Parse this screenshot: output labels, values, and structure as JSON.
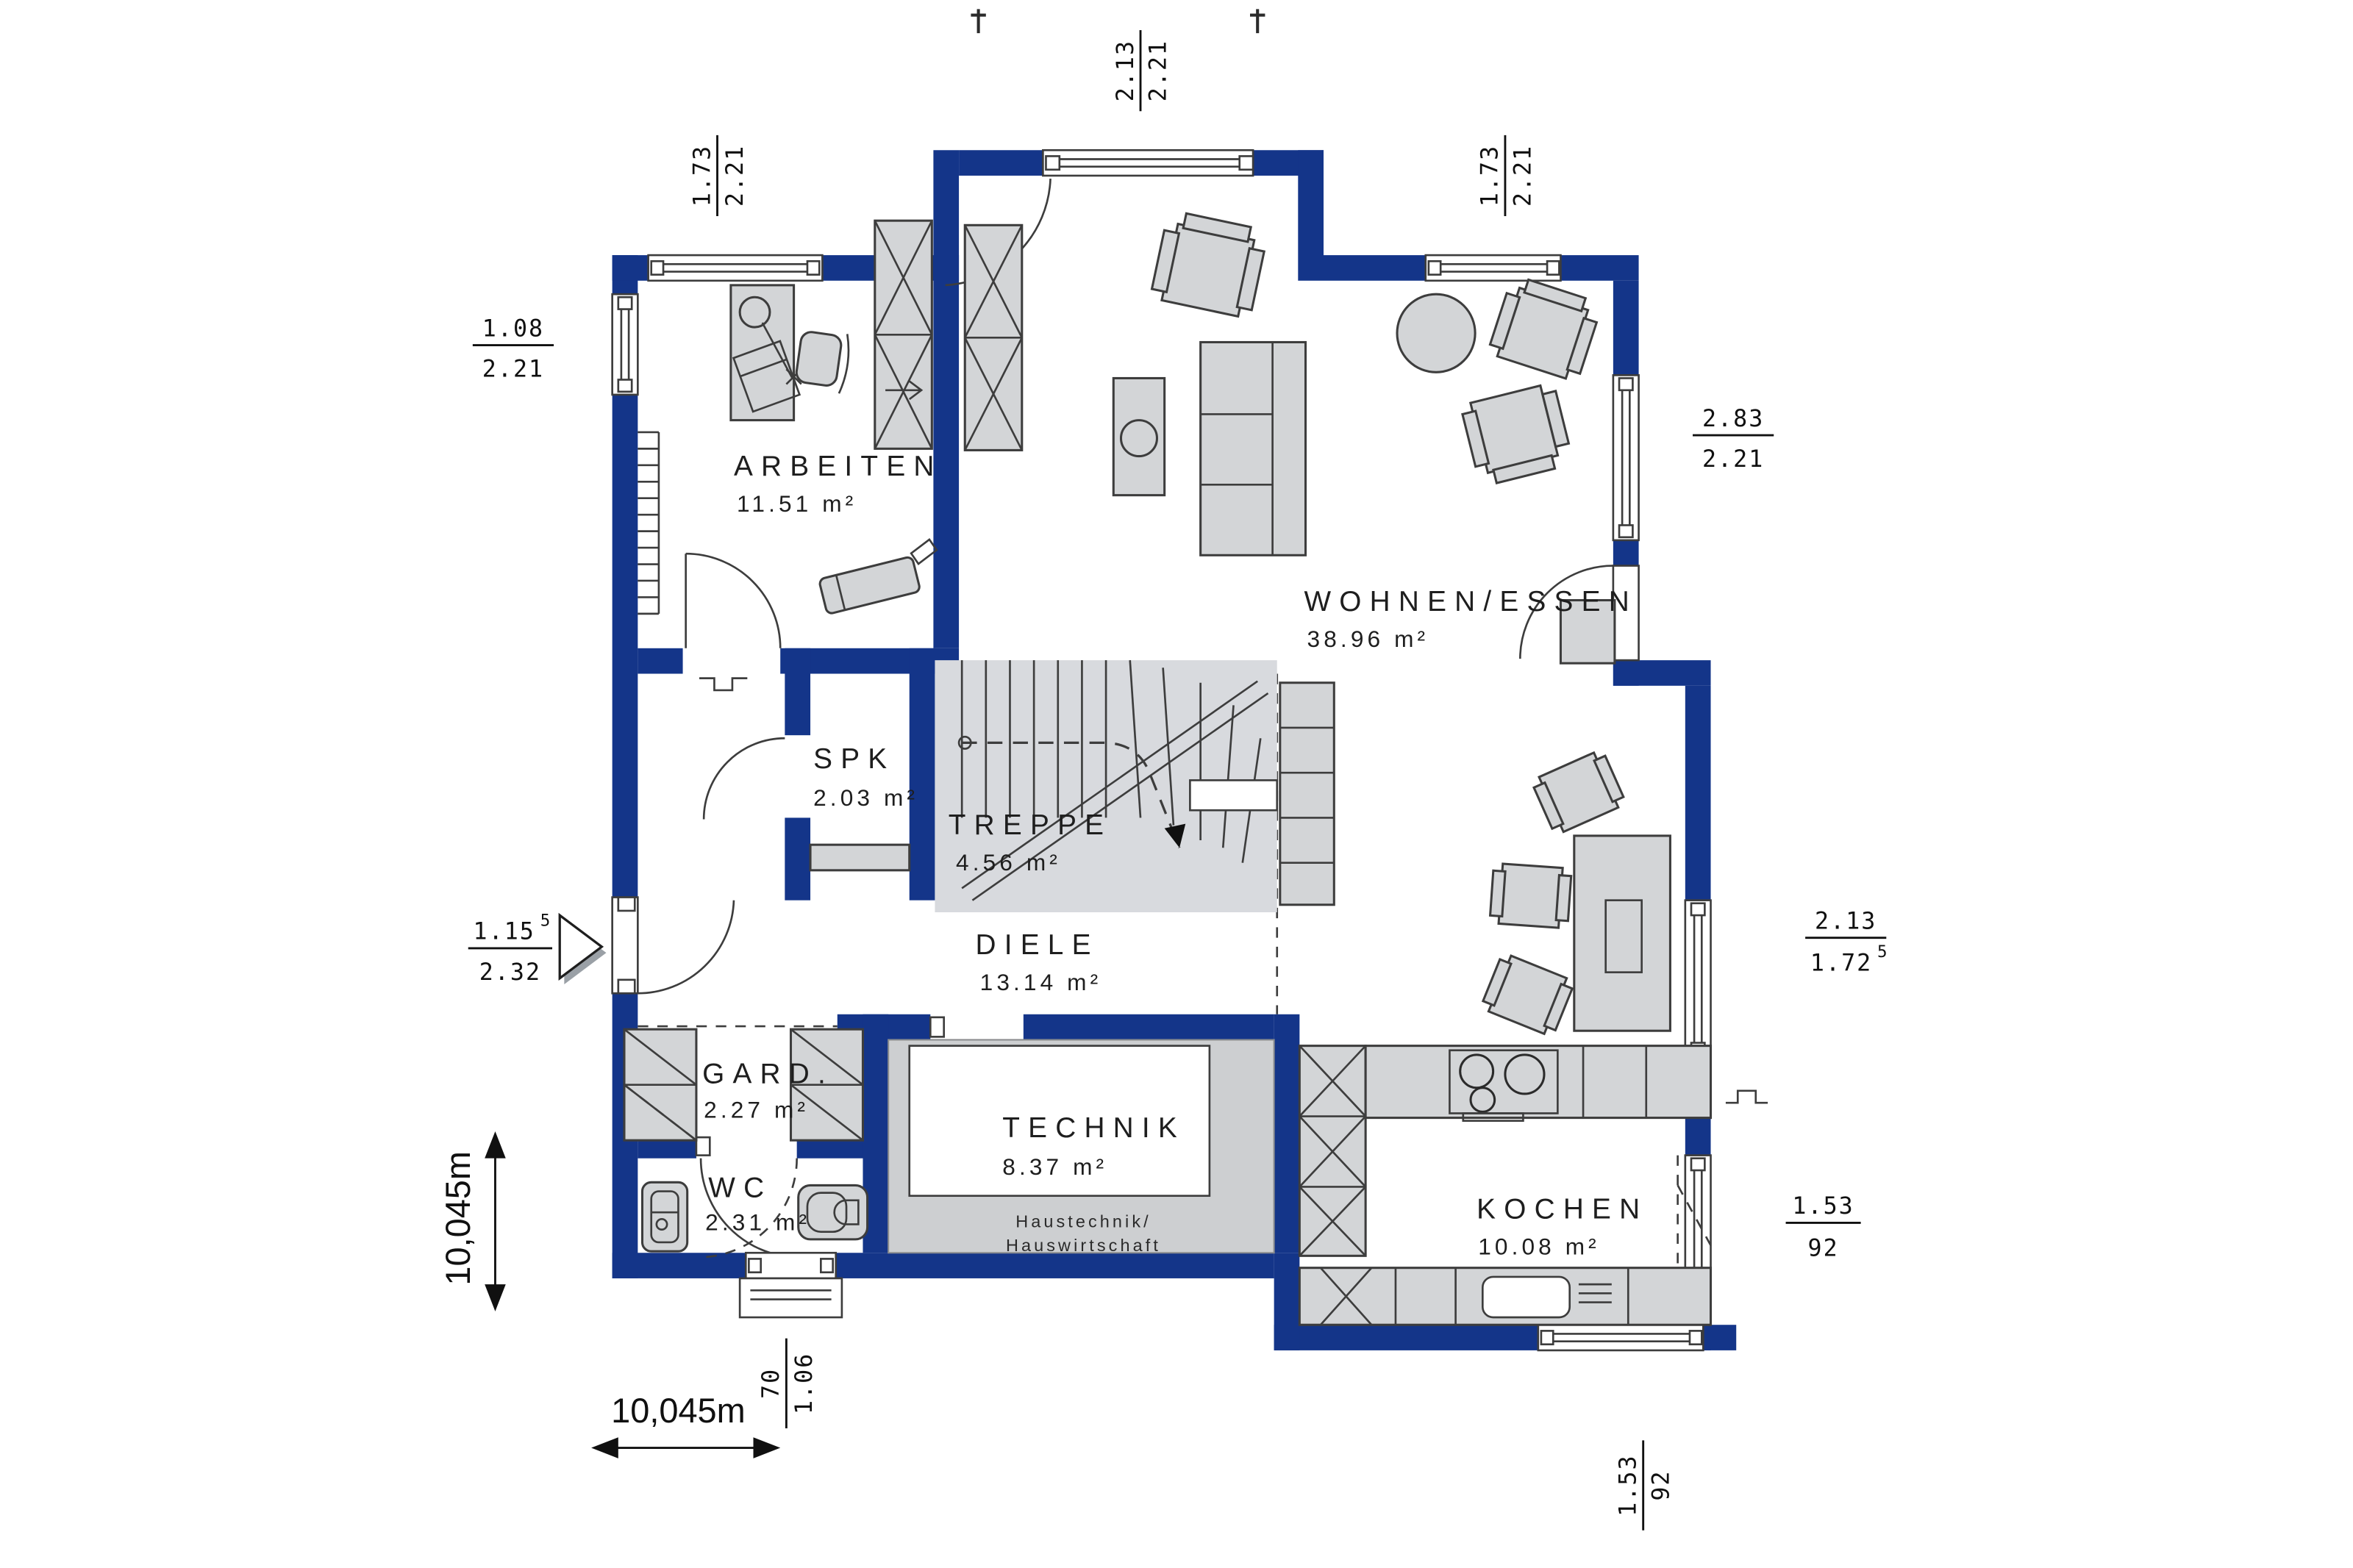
{
  "title": "Erdgeschoss Grundriss",
  "colors": {
    "wall": "#143589",
    "furniture_fill": "#d3d5d7",
    "stair_fill": "#d8dade",
    "technik_floor": "#cdcfd1",
    "outline": "#3d3d3d",
    "background": "#ffffff"
  },
  "rooms": [
    {
      "id": "arbeiten",
      "name": "ARBEITEN",
      "area": "11.51 m²"
    },
    {
      "id": "wohnen_essen",
      "name": "WOHNEN/ESSEN",
      "area": "38.96 m²"
    },
    {
      "id": "spk",
      "name": "SPK",
      "area": "2.03 m²"
    },
    {
      "id": "treppe",
      "name": "TREPPE",
      "area": "4.56 m²"
    },
    {
      "id": "diele",
      "name": "DIELE",
      "area": "13.14 m²"
    },
    {
      "id": "gard",
      "name": "GARD.",
      "area": "2.27 m²"
    },
    {
      "id": "wc",
      "name": "WC",
      "area": "2.31 m²"
    },
    {
      "id": "technik",
      "name": "TECHNIK",
      "area": "8.37 m²",
      "note1": "Haustechnik/",
      "note2": "Hauswirtschaft"
    },
    {
      "id": "kochen",
      "name": "KOCHEN",
      "area": "10.08 m²"
    }
  ],
  "dimensions": {
    "top_center": {
      "num": "2.13",
      "den": "2.21"
    },
    "top_left": {
      "num": "1.73",
      "den": "2.21"
    },
    "top_right": {
      "num": "1.73",
      "den": "2.21"
    },
    "left_upper": {
      "num": "1.08",
      "den": "2.21"
    },
    "left_entrance": {
      "num": "1.15",
      "num_sup": "5",
      "den": "2.32"
    },
    "right_upper": {
      "num": "2.83",
      "den": "2.21"
    },
    "right_mid": {
      "num": "2.13",
      "den": "1.72",
      "den_sup": "5"
    },
    "right_lower": {
      "num": "1.53",
      "den": "92"
    },
    "bottom_door": {
      "num": "70",
      "den": "1.06"
    },
    "bottom_kitchen": {
      "num": "1.53",
      "den": "92"
    },
    "overall_width": "10,045m",
    "overall_height": "10,045m"
  }
}
